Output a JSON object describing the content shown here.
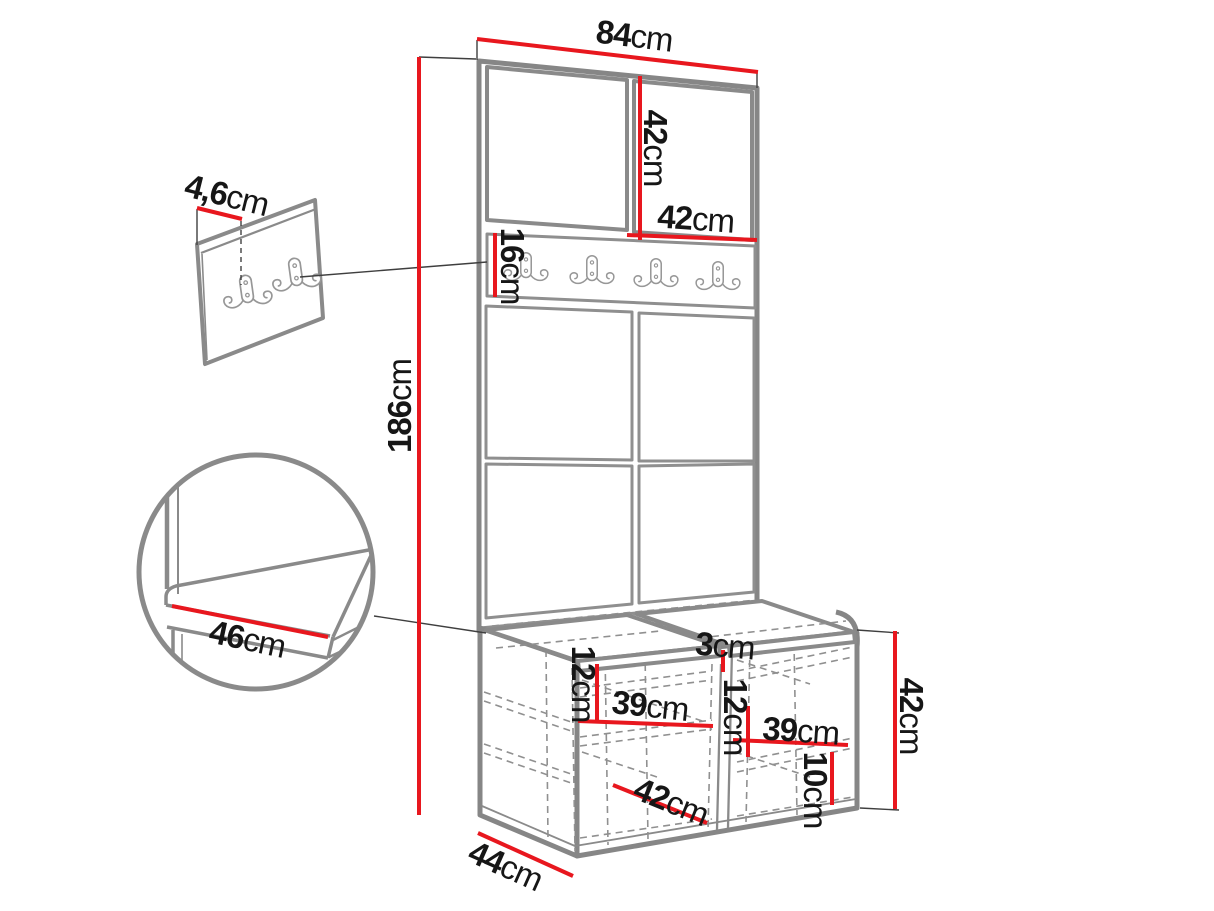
{
  "diagram": {
    "type": "furniture-dimension-diagram",
    "subject": "hallway wardrobe set with coat-hook rail, upholstered panels and shoe bench",
    "unit": "cm",
    "colors": {
      "background": "#ffffff",
      "dimension_line": "#e8171e",
      "furniture_outline": "#868686",
      "hidden_edge": "#909090",
      "label_text": "#161616"
    }
  },
  "labels": {
    "total_width": {
      "value": "84",
      "unit": "cm"
    },
    "upper_door_height": {
      "value": "42",
      "unit": "cm"
    },
    "upper_door_width": {
      "value": "42",
      "unit": "cm"
    },
    "hook_panel_height": {
      "value": "16",
      "unit": "cm"
    },
    "panel_thickness": {
      "value": "4,6",
      "unit": "cm"
    },
    "total_height": {
      "value": "186",
      "unit": "cm"
    },
    "seat_depth": {
      "value": "46",
      "unit": "cm"
    },
    "cushion_gap": {
      "value": "3",
      "unit": "cm"
    },
    "left_shelf_offset": {
      "value": "12",
      "unit": "cm"
    },
    "left_inner_width": {
      "value": "39",
      "unit": "cm"
    },
    "center_shelf_offset": {
      "value": "12",
      "unit": "cm"
    },
    "right_inner_width": {
      "value": "39",
      "unit": "cm"
    },
    "bottom_shelf_offset": {
      "value": "10",
      "unit": "cm"
    },
    "bench_inner_width": {
      "value": "42",
      "unit": "cm"
    },
    "bench_depth": {
      "value": "44",
      "unit": "cm"
    },
    "bench_height": {
      "value": "42",
      "unit": "cm"
    }
  }
}
